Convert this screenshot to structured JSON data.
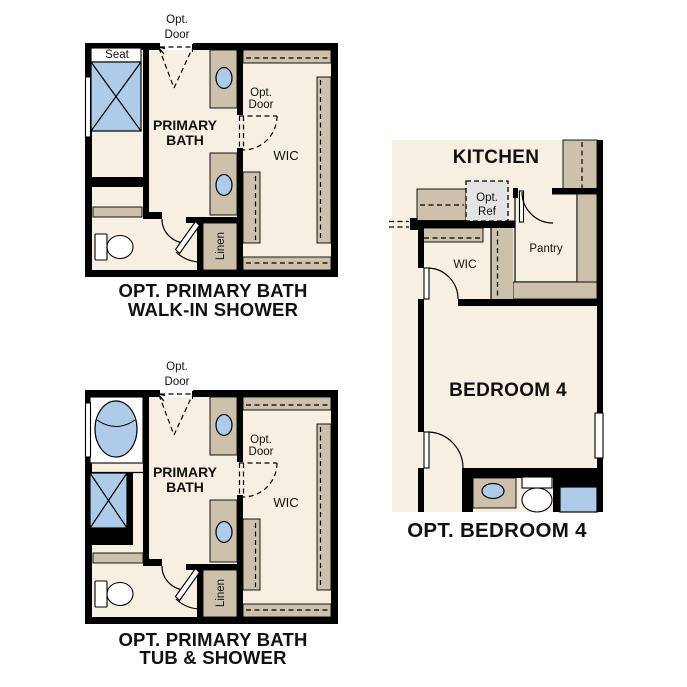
{
  "page": {
    "background": "#ffffff"
  },
  "colors": {
    "floor_cream": "#f6efe2",
    "cabinet_tan": "#cdc1ab",
    "fixture_blue": "#aecce9",
    "opt_ref_gray": "#e4e4e4",
    "wall_black": "#000000",
    "text": "#111111"
  },
  "labels": {
    "opt": "Opt.",
    "door": "Door",
    "ref": "Ref",
    "seat": "Seat",
    "primary": "PRIMARY",
    "bath": "BATH",
    "wic": "WIC",
    "linen": "Linen",
    "kitchen": "KITCHEN",
    "pantry": "Pantry",
    "bedroom4": "BEDROOM 4"
  },
  "captions": {
    "plan1_line1": "OPT. PRIMARY BATH",
    "plan1_line2": "WALK-IN SHOWER",
    "plan2_line1": "OPT. PRIMARY BATH",
    "plan2_line2": "TUB & SHOWER",
    "plan3": "OPT. BEDROOM 4"
  }
}
